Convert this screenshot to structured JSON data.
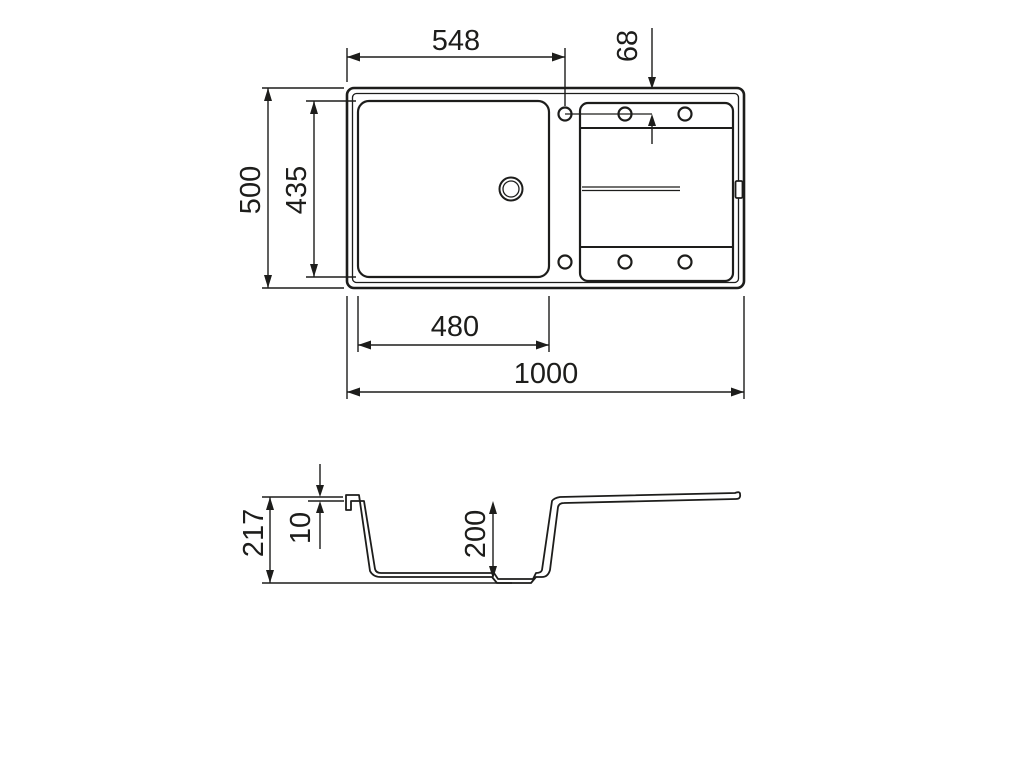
{
  "title": "Kitchen sink technical drawing",
  "colors": {
    "background": "#ffffff",
    "line": "#1d1d1b"
  },
  "top_view": {
    "dimensions": {
      "drain_center_from_left": "548",
      "tap_hole_from_top": "68",
      "overall_depth": "500",
      "bowl_inner_depth": "435",
      "bowl_inner_width": "480",
      "overall_width": "1000"
    }
  },
  "side_view": {
    "dimensions": {
      "overall_height": "217",
      "rim_thickness": "10",
      "bowl_depth": "200"
    }
  }
}
